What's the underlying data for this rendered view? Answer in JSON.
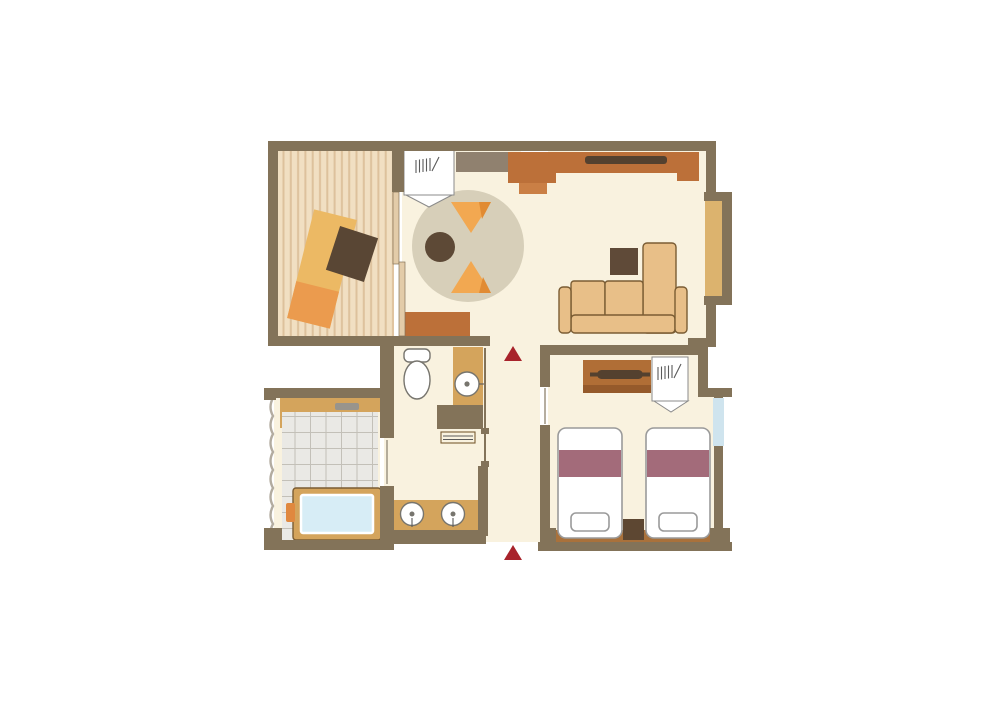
{
  "title": "hotel-guestroom-floor-plan",
  "palette": {
    "page_bg": "#ffffff",
    "wall": "#837359",
    "floor_cream": "#f9f2df",
    "tatami_base": "#f1dfc2",
    "tatami_stripe": "#ddc19c",
    "tile": "#eae9e5",
    "tile_line": "#c3c0b8",
    "rug": "#d7cfb9",
    "rug_triangle": "#f2a851",
    "rug_triangle_dark": "#e18b33",
    "rug_center": "#5d4936",
    "table_light": "#ecb964",
    "table_dark": "#eb9b4e",
    "cushion": "#594634",
    "counter_brown": "#bc7039",
    "counter_brown_step": "#ca7f45",
    "shelf_gray": "#90816f",
    "tv_dark": "#54412f",
    "sofa": "#e8bf88",
    "sofa_outline": "#7a5c33",
    "side_table": "#5f4a38",
    "bay_sill": "#dcb36e",
    "dresser": "#b06e36",
    "dresser_dark": "#955a2b",
    "bed_outline": "#9a9a9a",
    "bed_band": "#a36b7a",
    "night_stand": "#5d4732",
    "floor_strip": "#a9713b",
    "window_blue": "#cfe4ee",
    "tan_cabinet": "#d4a45c",
    "tub_water": "#d7edf6",
    "faucet_orange": "#e0883f",
    "fixture_outline": "#77756e",
    "gray_bar": "#98948c",
    "marker_red": "#a8232b",
    "scallop": "#b3aca0",
    "panel": "#e3cca9"
  },
  "rooms": [
    {
      "id": "tatami-room",
      "items": [
        "low-table",
        "floor-cushion",
        "striped-tatami-floor"
      ]
    },
    {
      "id": "living-room",
      "items": [
        "wardrobe-closet",
        "shelf",
        "kitchen-counter",
        "wall-tv",
        "round-rug",
        "rug-cushions",
        "round-table",
        "low-cabinet",
        "sofa",
        "sofa-chaise",
        "side-table",
        "bay-window-bench"
      ]
    },
    {
      "id": "toilet-room",
      "items": [
        "toilet",
        "hand-basin-cabinet",
        "bench"
      ]
    },
    {
      "id": "washroom",
      "items": [
        "vanity-counter",
        "sink-left",
        "sink-right"
      ]
    },
    {
      "id": "bathroom",
      "items": [
        "tile-floor",
        "shower-bar",
        "bathtub",
        "bath-faucet"
      ]
    },
    {
      "id": "hallway",
      "items": [
        "entrance-marker-top",
        "entrance-marker-bottom"
      ]
    },
    {
      "id": "bedroom",
      "items": [
        "dresser-tv-board",
        "tv",
        "closet-hangers",
        "window",
        "twin-bed-left",
        "twin-bed-right",
        "bed-runner-left",
        "bed-runner-right",
        "pillow-left",
        "pillow-right",
        "nightstand"
      ]
    }
  ],
  "markers": {
    "type": "entrance-arrow",
    "count": 2,
    "color": "#a8232b"
  }
}
